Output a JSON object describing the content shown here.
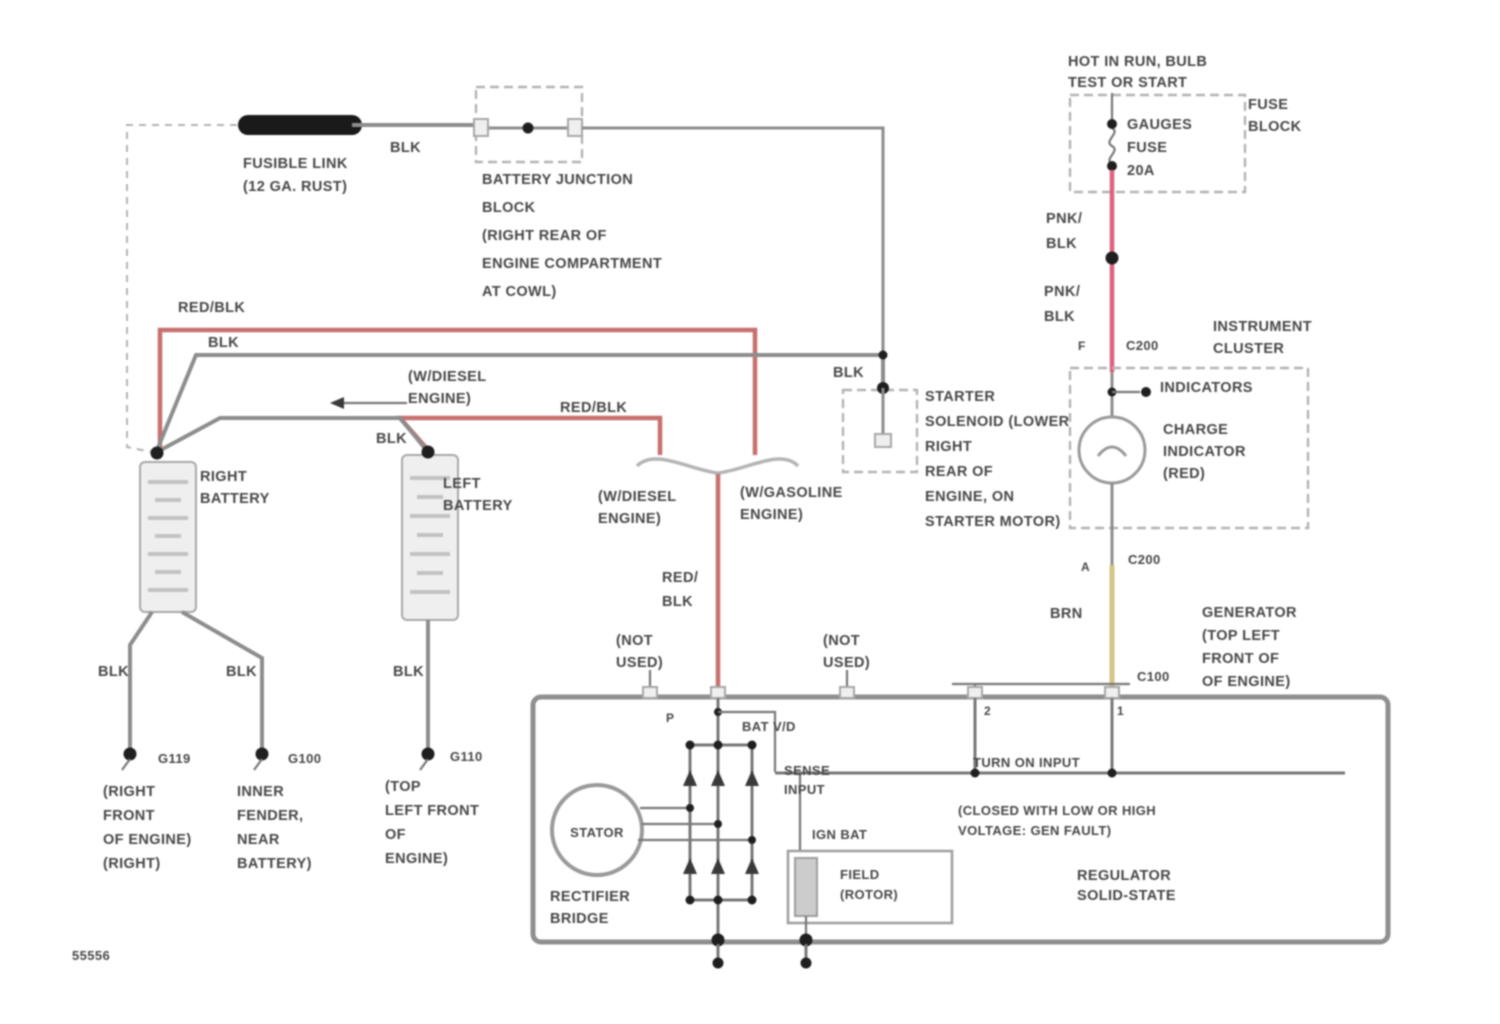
{
  "title": "Charging circuit wiring diagram - dual battery / generator",
  "diagram_id": "55556",
  "colors": {
    "wire_black": "#8d8d8d",
    "wire_red_blk": "#c7706e",
    "wire_pnk_blk": "#e0607e",
    "wire_brn": "#d6c583",
    "fusible_link": "#1a1a1a",
    "dashed_box": "#b3b3b3",
    "internal": "#787878",
    "component_fill": "#efefef",
    "text": "#474747",
    "id_text": "#9a9a9a"
  },
  "components": {
    "fusible_link": "FUSIBLE LINK (12 GA. RUST)",
    "battery_junction_block": "BATTERY JUNCTION BLOCK (RIGHT REAR OF ENGINE COMPARTMENT AT COWL)",
    "fuse": "GAUGES FUSE 20A",
    "fuse_block": "FUSE BLOCK",
    "instrument_cluster": "INSTRUMENT CLUSTER",
    "charge_indicator": "CHARGE INDICATOR (RED)",
    "generator": "GENERATOR (TOP LEFT FRONT OF ENGINE)",
    "starter_solenoid": "STARTER SOLENOID (LOWER RIGHT REAR OF ENGINE, ON STARTER MOTOR)",
    "right_battery": "RIGHT BATTERY",
    "left_battery": "LEFT BATTERY",
    "connectors": [
      "C200",
      "C100"
    ],
    "grounds": [
      "G119",
      "G100",
      "G110"
    ]
  },
  "labels": [
    {
      "name": "fusible-link-label",
      "x": 243,
      "y": 168,
      "lines": [
        "FUSIBLE LINK",
        "(12 GA. RUST)"
      ]
    },
    {
      "name": "wire-blk-fusible",
      "x": 390,
      "y": 152,
      "lines": [
        "BLK"
      ]
    },
    {
      "name": "battery-junction-block-label",
      "x": 482,
      "y": 184,
      "lh": 28,
      "lines": [
        "BATTERY JUNCTION",
        "BLOCK",
        "(RIGHT REAR OF",
        "ENGINE COMPARTMENT",
        "AT COWL)"
      ]
    },
    {
      "name": "hot-in-run-label",
      "x": 1068,
      "y": 66,
      "lh": 21,
      "lines": [
        "HOT IN RUN, BULB",
        "TEST OR START"
      ]
    },
    {
      "name": "fuse-block-label",
      "x": 1248,
      "y": 109,
      "lh": 22,
      "lines": [
        "FUSE",
        "BLOCK"
      ]
    },
    {
      "name": "gauges-fuse-label",
      "x": 1127,
      "y": 129,
      "lh": 23,
      "lines": [
        "GAUGES",
        "FUSE",
        "20A"
      ]
    },
    {
      "name": "wire-pnk-blk-upper",
      "x": 1046,
      "y": 223,
      "lh": 25,
      "lines": [
        "PNK/",
        "BLK"
      ]
    },
    {
      "name": "wire-pnk-blk-lower",
      "x": 1044,
      "y": 296,
      "lh": 25,
      "lines": [
        "PNK/",
        "BLK"
      ]
    },
    {
      "name": "pin-f",
      "x": 1078,
      "y": 350,
      "size": 12,
      "lines": [
        "F"
      ]
    },
    {
      "name": "connector-c200-top",
      "x": 1126,
      "y": 350,
      "size": 13,
      "lines": [
        "C200"
      ]
    },
    {
      "name": "instrument-cluster-label",
      "x": 1213,
      "y": 331,
      "lh": 22,
      "lines": [
        "INSTRUMENT",
        "CLUSTER"
      ]
    },
    {
      "name": "indicators-label",
      "x": 1160,
      "y": 392,
      "lines": [
        "INDICATORS"
      ]
    },
    {
      "name": "charge-indicator-label",
      "x": 1163,
      "y": 434,
      "lh": 22,
      "lines": [
        "CHARGE",
        "INDICATOR",
        "(RED)"
      ]
    },
    {
      "name": "pin-a",
      "x": 1081,
      "y": 571,
      "size": 12,
      "lines": [
        "A"
      ]
    },
    {
      "name": "connector-c200-bottom",
      "x": 1128,
      "y": 564,
      "size": 13,
      "lines": [
        "C200"
      ]
    },
    {
      "name": "wire-brn",
      "x": 1050,
      "y": 618,
      "lines": [
        "BRN"
      ]
    },
    {
      "name": "connector-c100",
      "x": 1137,
      "y": 681,
      "size": 13,
      "lines": [
        "C100"
      ]
    },
    {
      "name": "generator-label",
      "x": 1202,
      "y": 617,
      "lh": 23,
      "lines": [
        "GENERATOR",
        "(TOP LEFT",
        "FRONT OF",
        "OF ENGINE)"
      ]
    },
    {
      "name": "wire-red-blk-top",
      "x": 178,
      "y": 312,
      "lines": [
        "RED/BLK"
      ]
    },
    {
      "name": "wire-blk-starter",
      "x": 208,
      "y": 347,
      "lines": [
        "BLK"
      ]
    },
    {
      "name": "w-diesel-arrow-label",
      "x": 408,
      "y": 381,
      "lh": 22,
      "lines": [
        "(W/DIESEL",
        "ENGINE)"
      ]
    },
    {
      "name": "wire-red-blk-left",
      "x": 560,
      "y": 412,
      "lines": [
        "RED/BLK"
      ]
    },
    {
      "name": "wire-blk-left-battery",
      "x": 376,
      "y": 443,
      "lines": [
        "BLK"
      ]
    },
    {
      "name": "right-battery-label",
      "x": 200,
      "y": 481,
      "lh": 22,
      "lines": [
        "RIGHT",
        "BATTERY"
      ]
    },
    {
      "name": "left-battery-label",
      "x": 443,
      "y": 488,
      "lh": 22,
      "lines": [
        "LEFT",
        "BATTERY"
      ]
    },
    {
      "name": "w-diesel-brace-label",
      "x": 598,
      "y": 501,
      "lh": 22,
      "lines": [
        "(W/DIESEL",
        "ENGINE)"
      ]
    },
    {
      "name": "w-gasoline-brace-label",
      "x": 740,
      "y": 497,
      "lh": 22,
      "lines": [
        "(W/GASOLINE",
        "ENGINE)"
      ]
    },
    {
      "name": "wire-red-blk-center",
      "x": 662,
      "y": 582,
      "lh": 24,
      "lines": [
        "RED/",
        "BLK"
      ]
    },
    {
      "name": "not-used-left",
      "x": 616,
      "y": 645,
      "lh": 22,
      "lines": [
        "(NOT",
        "USED)"
      ]
    },
    {
      "name": "not-used-right",
      "x": 823,
      "y": 645,
      "lh": 22,
      "lines": [
        "(NOT",
        "USED)"
      ]
    },
    {
      "name": "wire-blk-solenoid",
      "x": 833,
      "y": 377,
      "lines": [
        "BLK"
      ]
    },
    {
      "name": "starter-solenoid-label",
      "x": 925,
      "y": 401,
      "lh": 25,
      "lines": [
        "STARTER",
        "SOLENOID (LOWER",
        "RIGHT",
        "REAR OF",
        "ENGINE, ON",
        "STARTER MOTOR)"
      ]
    },
    {
      "name": "pin-p",
      "x": 666,
      "y": 722,
      "size": 12,
      "lines": [
        "P"
      ]
    },
    {
      "name": "bat-terminal-label",
      "x": 742,
      "y": 731,
      "size": 13,
      "lines": [
        "BAT V/D"
      ]
    },
    {
      "name": "sense-input-label",
      "x": 784,
      "y": 775,
      "size": 13,
      "lh": 19,
      "lines": [
        "SENSE",
        "INPUT"
      ]
    },
    {
      "name": "turn-on-input-label",
      "x": 973,
      "y": 767,
      "size": 13,
      "lines": [
        "TURN ON INPUT"
      ]
    },
    {
      "name": "ign-bat-label",
      "x": 812,
      "y": 839,
      "size": 13,
      "lines": [
        "IGN BAT"
      ]
    },
    {
      "name": "gen-fault-label",
      "x": 958,
      "y": 815,
      "size": 13,
      "lh": 20,
      "lines": [
        "(CLOSED WITH LOW OR HIGH",
        "VOLTAGE: GEN FAULT)"
      ]
    },
    {
      "name": "field-rotor-label",
      "x": 840,
      "y": 879,
      "size": 13,
      "lh": 20,
      "lines": [
        "FIELD",
        "(ROTOR)"
      ]
    },
    {
      "name": "regulator-label",
      "x": 1077,
      "y": 880,
      "lh": 20,
      "lines": [
        "REGULATOR",
        "SOLID-STATE"
      ]
    },
    {
      "name": "rectifier-bridge-label",
      "x": 550,
      "y": 901,
      "lh": 22,
      "lines": [
        "RECTIFIER",
        "BRIDGE"
      ]
    },
    {
      "name": "stator-label",
      "x": 597,
      "y": 837,
      "size": 13,
      "align": "middle",
      "lines": [
        "STATOR"
      ]
    },
    {
      "name": "pin-2",
      "x": 984,
      "y": 715,
      "size": 12,
      "lines": [
        "2"
      ]
    },
    {
      "name": "pin-1",
      "x": 1117,
      "y": 715,
      "size": 12,
      "lines": [
        "1"
      ]
    },
    {
      "name": "wire-blk-ground1",
      "x": 98,
      "y": 676,
      "lines": [
        "BLK"
      ]
    },
    {
      "name": "wire-blk-ground2",
      "x": 226,
      "y": 676,
      "lines": [
        "BLK"
      ]
    },
    {
      "name": "wire-blk-ground3",
      "x": 393,
      "y": 676,
      "lines": [
        "BLK"
      ]
    },
    {
      "name": "ground-code-g119",
      "x": 158,
      "y": 763,
      "size": 13,
      "lines": [
        "G119"
      ]
    },
    {
      "name": "ground-code-g100",
      "x": 288,
      "y": 763,
      "size": 13,
      "lines": [
        "G100"
      ]
    },
    {
      "name": "ground-code-g110",
      "x": 450,
      "y": 761,
      "size": 13,
      "lines": [
        "G110"
      ]
    },
    {
      "name": "ground1-location",
      "x": 103,
      "y": 796,
      "lh": 24,
      "lines": [
        "(RIGHT",
        "FRONT",
        "OF ENGINE)",
        "(RIGHT)"
      ]
    },
    {
      "name": "ground2-location",
      "x": 237,
      "y": 796,
      "lh": 24,
      "lines": [
        "INNER",
        "FENDER,",
        "NEAR",
        "BATTERY)"
      ]
    },
    {
      "name": "ground3-location",
      "x": 385,
      "y": 791,
      "lh": 24,
      "lines": [
        "(TOP",
        "LEFT FRONT",
        "OF",
        "ENGINE)"
      ]
    },
    {
      "name": "diagram-id",
      "x": 72,
      "y": 960,
      "size": 13,
      "fill": "#9a9a9a",
      "lines": [
        "55556"
      ]
    }
  ]
}
